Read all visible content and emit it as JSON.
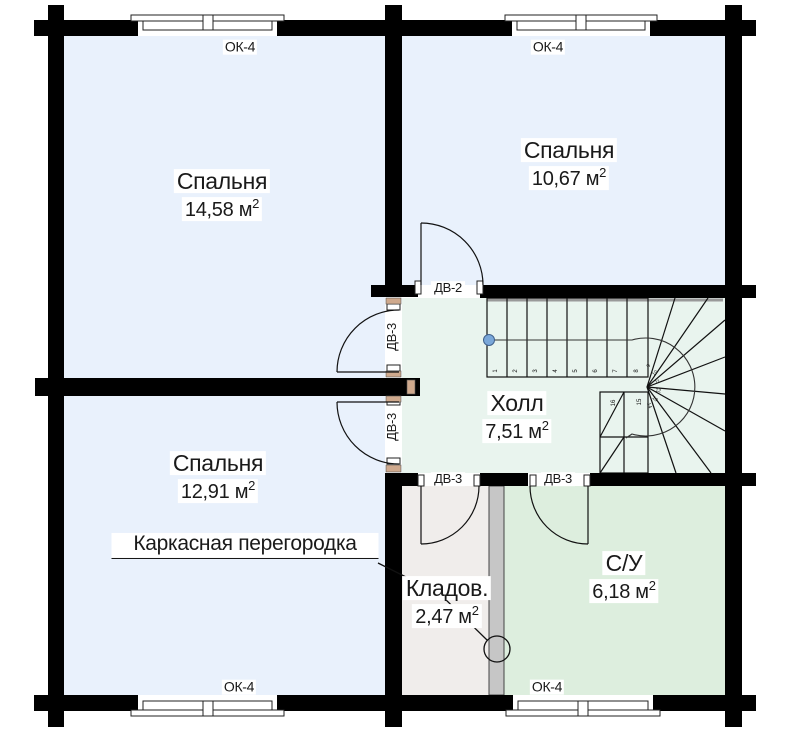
{
  "rooms": [
    {
      "id": "bedroom-top-left",
      "name": "Спальня",
      "area": "14,58"
    },
    {
      "id": "bedroom-top-right",
      "name": "Спальня",
      "area": "10,67"
    },
    {
      "id": "bedroom-bottom-left",
      "name": "Спальня",
      "area": "12,91"
    },
    {
      "id": "hall",
      "name": "Холл",
      "area": "7,51"
    },
    {
      "id": "bathroom",
      "name": "С/У",
      "area": "6,18"
    },
    {
      "id": "storage",
      "name": "Кладов.",
      "area": "2,47"
    }
  ],
  "units": {
    "area_unit": "м",
    "area_sup": "2"
  },
  "windows": [
    {
      "id": "window-top-left",
      "label": "ОК-4"
    },
    {
      "id": "window-top-right",
      "label": "ОК-4"
    },
    {
      "id": "window-bottom-left",
      "label": "ОК-4"
    },
    {
      "id": "window-bottom-right",
      "label": "ОК-4"
    }
  ],
  "doors": [
    {
      "id": "door-hall-bedroom-top-right",
      "label": "ДВ-2"
    },
    {
      "id": "door-hall-bedroom-top-left",
      "label": "ДВ-3"
    },
    {
      "id": "door-hall-bedroom-bottom-left",
      "label": "ДВ-3"
    },
    {
      "id": "door-hall-storage",
      "label": "ДВ-3"
    },
    {
      "id": "door-hall-bathroom",
      "label": "ДВ-3"
    }
  ],
  "annotations": {
    "partition_note": "Каркасная перегородка"
  },
  "stairs": {
    "steps": [
      "1",
      "2",
      "3",
      "4",
      "5",
      "6",
      "7",
      "8",
      "9",
      "10",
      "11",
      "12",
      "13",
      "14",
      "15",
      "16"
    ]
  },
  "colors": {
    "wall": "#000000",
    "bedroom": "#e9f1fc",
    "hall": "#e9f4ee",
    "bathroom": "#ddeede",
    "storage": "#f0edeb",
    "partition": "#c6c6c6",
    "line": "#111111",
    "walk_dot": "#7aa7d9"
  }
}
